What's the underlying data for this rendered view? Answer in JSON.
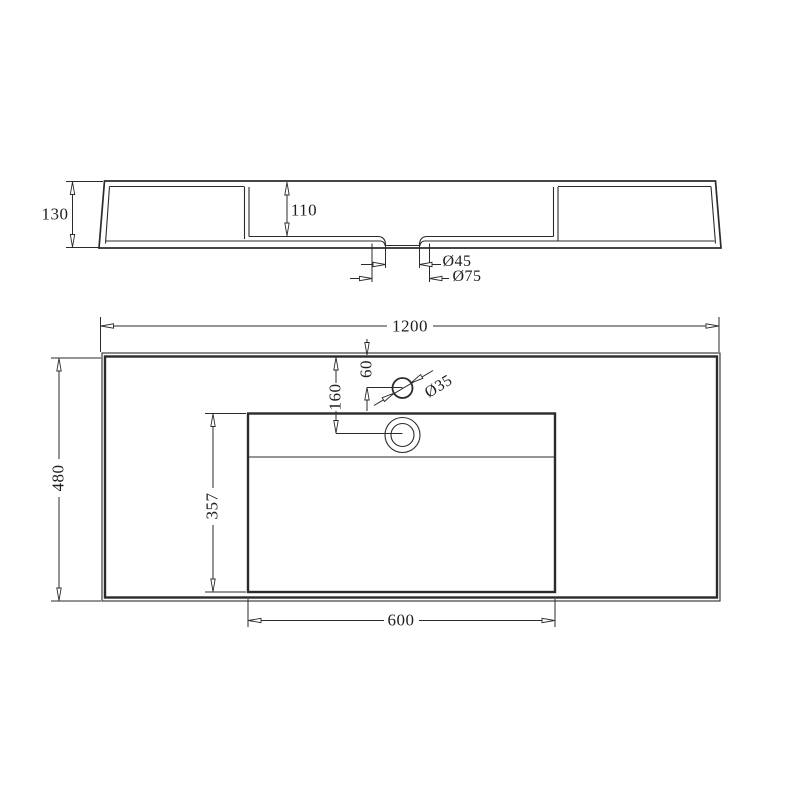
{
  "drawing_type": "technical-dimension-drawing",
  "subject": "wall-hung basin / vanity top — front section view and plan view",
  "colors": {
    "line": "#2b2b2b",
    "background": "#ffffff"
  },
  "side_view": {
    "overall_height": "130",
    "bowl_depth": "110",
    "drain_inner_diameter": "Ø45",
    "drain_outer_diameter": "Ø75"
  },
  "plan_view": {
    "overall_width": "1200",
    "overall_depth": "480",
    "tap_hole_offset": "60",
    "drain_center_offset": "160",
    "tap_hole_diameter": "Ø35",
    "bowl_inner_depth": "357",
    "bowl_inner_width": "600"
  }
}
